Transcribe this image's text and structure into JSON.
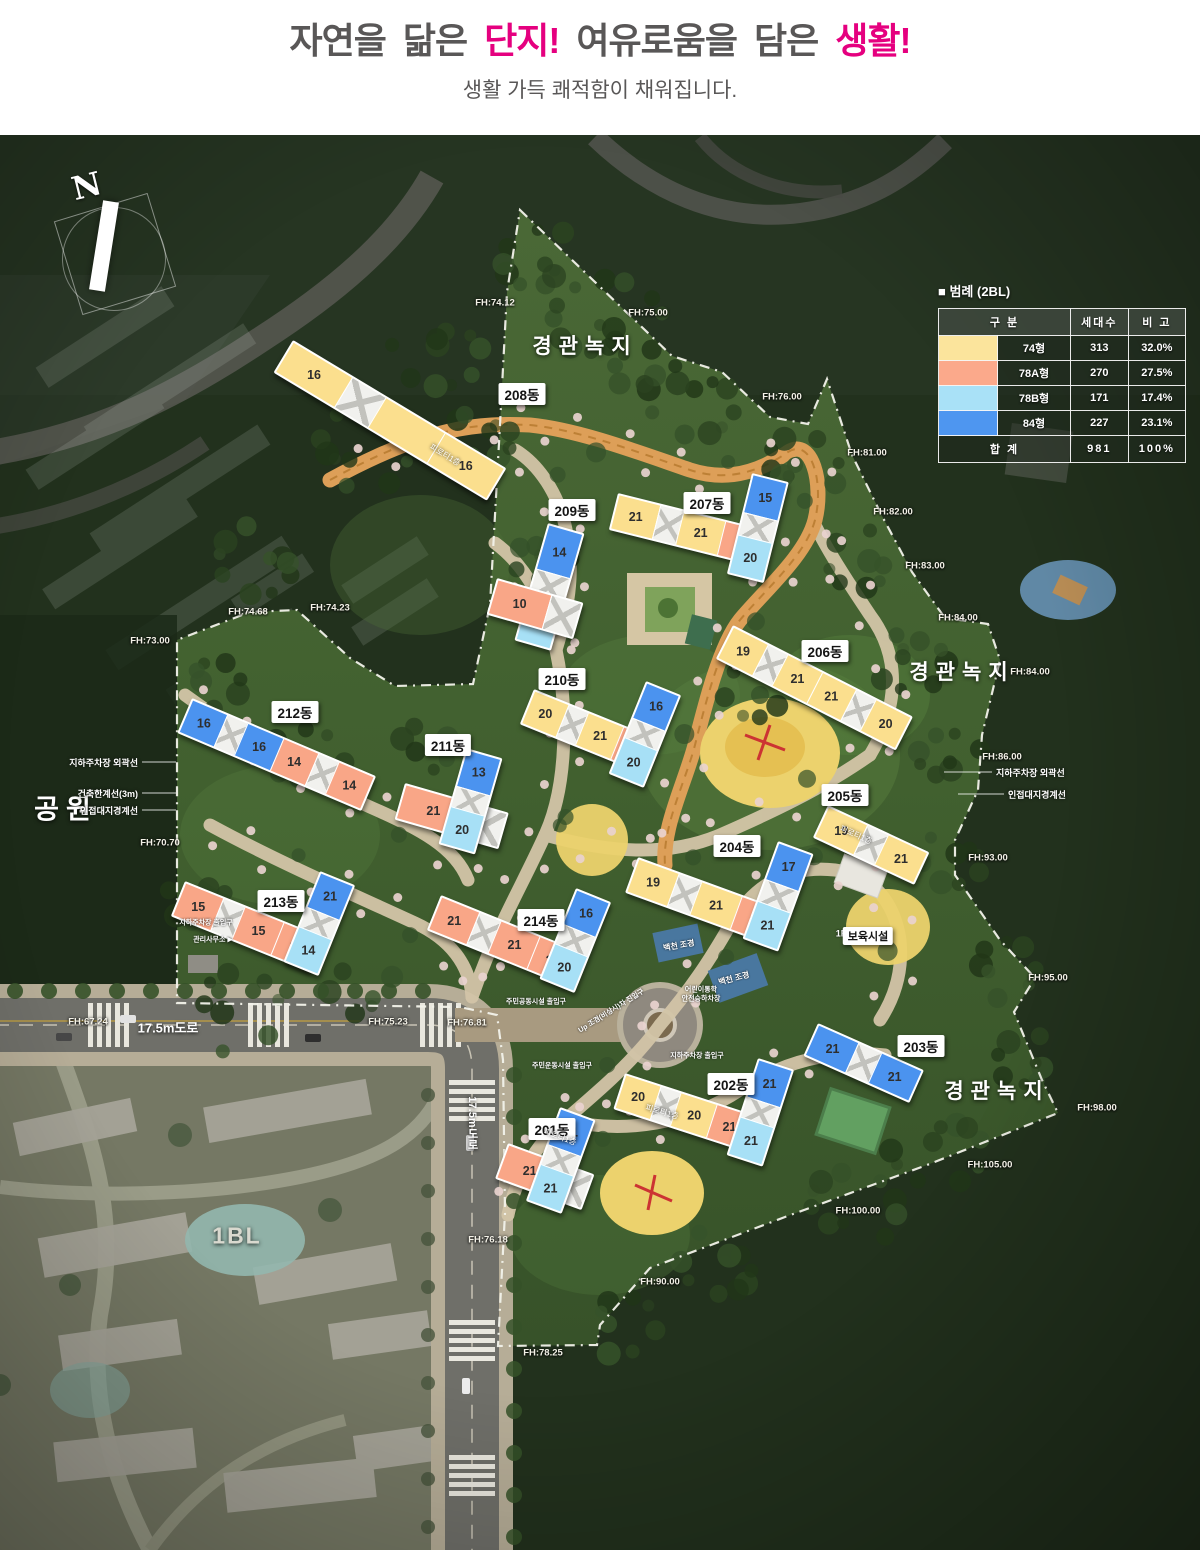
{
  "header": {
    "title_parts": [
      {
        "text": "자연을 닮은 ",
        "color": "#595757"
      },
      {
        "text": "단지!",
        "color": "#e5007f"
      },
      {
        "text": " 여유로움을 담은 ",
        "color": "#595757"
      },
      {
        "text": "생활!",
        "color": "#e5007f"
      }
    ],
    "subtitle": "생활 가득 쾌적함이 채워집니다."
  },
  "legend": {
    "title": "■  범례 (2BL)",
    "columns": [
      "구   분",
      "세대수",
      "비 고"
    ],
    "colors": {
      "Y": "#fbdf8e",
      "S": "#f9a687",
      "C": "#a7e0f6",
      "B": "#4b93ef",
      "W": "#ffffff"
    },
    "rows": [
      {
        "color": "#fbe49c",
        "type": "74형",
        "households": "313",
        "ratio": "32.0%"
      },
      {
        "color": "#fba98b",
        "type": "78A형",
        "households": "270",
        "ratio": "27.5%"
      },
      {
        "color": "#a9e1f7",
        "type": "78B형",
        "households": "171",
        "ratio": "17.4%"
      },
      {
        "color": "#4e96f0",
        "type": "84형",
        "households": "227",
        "ratio": "23.1%"
      }
    ],
    "total": {
      "label": "합 계",
      "households": "981",
      "ratio": "100%"
    }
  },
  "labels": {
    "north": "N",
    "green_zone": "경관녹지",
    "park": "공원",
    "block": "1BL",
    "road_17_5": "17.5m도로",
    "daycare": "보육시설",
    "daycare_floor": "1F",
    "stream": "백천 조경",
    "mgmt_office": "관리사무소 ▶",
    "parking_entrance": "지하주차장 출입구",
    "parking_entrance2": "지하주차장 출입구",
    "kids_dropoff": "어린이통학\n안전승하차장",
    "landscape_entry": "Up 조경(비상시)차 진입구",
    "community_entrance": "주민공동시설 출입구",
    "sports_entrance": "주민운동시설 출입구",
    "boundary_notes_left": [
      "지하주차장 외곽선",
      "건축한계선(3m)",
      "인접대지경계선"
    ],
    "boundary_notes_right": [
      "지하주차장 외곽선",
      "인접대지경계선"
    ]
  },
  "map": {
    "fh_points": [
      {
        "t": "FH:74.12",
        "x": 495,
        "y": 168
      },
      {
        "t": "FH:75.00",
        "x": 648,
        "y": 178
      },
      {
        "t": "FH:76.00",
        "x": 782,
        "y": 262
      },
      {
        "t": "FH:81.00",
        "x": 867,
        "y": 318
      },
      {
        "t": "FH:82.00",
        "x": 893,
        "y": 377
      },
      {
        "t": "FH:83.00",
        "x": 925,
        "y": 431
      },
      {
        "t": "FH:84.00",
        "x": 958,
        "y": 483
      },
      {
        "t": "FH:84.00",
        "x": 1030,
        "y": 537
      },
      {
        "t": "FH:86.00",
        "x": 1002,
        "y": 622
      },
      {
        "t": "FH:93.00",
        "x": 988,
        "y": 723
      },
      {
        "t": "FH:95.00",
        "x": 1048,
        "y": 843
      },
      {
        "t": "FH:98.00",
        "x": 1097,
        "y": 973
      },
      {
        "t": "FH:105.00",
        "x": 990,
        "y": 1030
      },
      {
        "t": "FH:100.00",
        "x": 858,
        "y": 1076
      },
      {
        "t": "FH:90.00",
        "x": 660,
        "y": 1147
      },
      {
        "t": "FH:78.25",
        "x": 543,
        "y": 1218
      },
      {
        "t": "FH:76.18",
        "x": 488,
        "y": 1105
      },
      {
        "t": "FH:67.24",
        "x": 88,
        "y": 887
      },
      {
        "t": "FH:75.23",
        "x": 388,
        "y": 887
      },
      {
        "t": "FH:76.81",
        "x": 467,
        "y": 888
      },
      {
        "t": "FH:74.68",
        "x": 248,
        "y": 477
      },
      {
        "t": "FH:74.23",
        "x": 330,
        "y": 473
      },
      {
        "t": "FH:73.00",
        "x": 150,
        "y": 506
      },
      {
        "t": "FH:70.70",
        "x": 160,
        "y": 708
      }
    ],
    "buildings": [
      {
        "name": "201동",
        "lx": 552,
        "ly": 994,
        "note": "피로티1층",
        "nx": 560,
        "ny": 1002,
        "nr": 20,
        "bars": [
          {
            "x": 508,
            "y": 1008,
            "w": 88,
            "h": 34,
            "rot": 20,
            "dir": "h",
            "segs": [
              {
                "c": "S",
                "n": "21"
              },
              {
                "c": "W"
              }
            ]
          },
          {
            "x": 560,
            "y": 972,
            "w": 34,
            "h": 96,
            "rot": 20,
            "dir": "v",
            "segs": [
              {
                "c": "B",
                "n": "21"
              },
              {
                "c": "W"
              },
              {
                "c": "C",
                "n": "21"
              }
            ]
          }
        ]
      },
      {
        "name": "202동",
        "lx": 731,
        "ly": 949,
        "note": "피로티1층",
        "nx": 662,
        "ny": 977,
        "nr": 16,
        "bars": [
          {
            "x": 625,
            "y": 938,
            "w": 132,
            "h": 34,
            "rot": 18,
            "dir": "h",
            "segs": [
              {
                "c": "Y",
                "n": "20"
              },
              {
                "c": "W"
              },
              {
                "c": "Y",
                "n": "20"
              },
              {
                "c": "S",
                "n": "21"
              }
            ]
          },
          {
            "x": 758,
            "y": 923,
            "w": 34,
            "h": 98,
            "rot": 18,
            "dir": "v",
            "segs": [
              {
                "c": "B",
                "n": "21"
              },
              {
                "c": "W"
              },
              {
                "c": "C",
                "n": "21"
              }
            ]
          }
        ]
      },
      {
        "name": "203동",
        "lx": 921,
        "ly": 911,
        "bars": [
          {
            "x": 818,
            "y": 888,
            "w": 112,
            "h": 32,
            "rot": 24,
            "dir": "h",
            "segs": [
              {
                "c": "B",
                "n": "21"
              },
              {
                "c": "W"
              },
              {
                "c": "B",
                "n": "21"
              }
            ]
          }
        ]
      },
      {
        "name": "204동",
        "lx": 737,
        "ly": 711,
        "bars": [
          {
            "x": 638,
            "y": 722,
            "w": 152,
            "h": 34,
            "rot": 20,
            "dir": "h",
            "segs": [
              {
                "c": "Y",
                "n": "19"
              },
              {
                "c": "W"
              },
              {
                "c": "Y",
                "n": "21"
              },
              {
                "c": "S",
                "n": "21"
              }
            ]
          },
          {
            "x": 778,
            "y": 706,
            "w": 34,
            "h": 100,
            "rot": 20,
            "dir": "v",
            "segs": [
              {
                "c": "B",
                "n": "17"
              },
              {
                "c": "W"
              },
              {
                "c": "C",
                "n": "21"
              }
            ]
          }
        ]
      },
      {
        "name": "205동",
        "lx": 845,
        "ly": 660,
        "note": "피로티1층",
        "nx": 856,
        "ny": 700,
        "nr": 24,
        "bars": [
          {
            "x": 828,
            "y": 670,
            "w": 108,
            "h": 32,
            "rot": 25,
            "dir": "h",
            "segs": [
              {
                "c": "Y",
                "n": "19"
              },
              {
                "c": "W"
              },
              {
                "c": "Y",
                "n": "21"
              }
            ]
          }
        ]
      },
      {
        "name": "206동",
        "lx": 825,
        "ly": 516,
        "bars": [
          {
            "x": 733,
            "y": 490,
            "w": 198,
            "h": 34,
            "rot": 27,
            "dir": "h",
            "segs": [
              {
                "c": "Y",
                "n": "19"
              },
              {
                "c": "W"
              },
              {
                "c": "Y",
                "n": "21"
              },
              {
                "c": "Y",
                "n": "21"
              },
              {
                "c": "W"
              },
              {
                "c": "Y",
                "n": "20"
              }
            ]
          }
        ]
      },
      {
        "name": "207동",
        "lx": 707,
        "ly": 368,
        "bars": [
          {
            "x": 618,
            "y": 358,
            "w": 152,
            "h": 34,
            "rot": 14,
            "dir": "h",
            "segs": [
              {
                "c": "Y",
                "n": "21"
              },
              {
                "c": "W"
              },
              {
                "c": "Y",
                "n": "21"
              },
              {
                "c": "S",
                "n": "21"
              }
            ]
          },
          {
            "x": 752,
            "y": 338,
            "w": 34,
            "h": 100,
            "rot": 14,
            "dir": "v",
            "segs": [
              {
                "c": "B",
                "n": "15"
              },
              {
                "c": "W"
              },
              {
                "c": "C",
                "n": "20"
              }
            ]
          }
        ]
      },
      {
        "name": "208동",
        "lx": 522,
        "ly": 259,
        "note": "피로티1층",
        "nx": 445,
        "ny": 320,
        "nr": 31,
        "bars": [
          {
            "x": 293,
            "y": 205,
            "w": 245,
            "h": 34,
            "rot": 31,
            "dir": "h",
            "segs": [
              {
                "c": "Y",
                "n": "16"
              },
              {
                "c": "W"
              },
              {
                "c": "Y"
              },
              {
                "c": "Y",
                "n": "16"
              }
            ]
          }
        ]
      },
      {
        "name": "209동",
        "lx": 572,
        "ly": 375,
        "bars": [
          {
            "x": 548,
            "y": 388,
            "w": 34,
            "h": 118,
            "rot": 16,
            "dir": "v",
            "segs": [
              {
                "c": "B",
                "n": "14"
              },
              {
                "c": "W"
              },
              {
                "c": "C",
                "n": "14"
              }
            ]
          },
          {
            "x": 497,
            "y": 443,
            "w": 86,
            "h": 34,
            "rot": 16,
            "dir": "h",
            "segs": [
              {
                "c": "S",
                "n": "10"
              },
              {
                "c": "W"
              }
            ]
          }
        ]
      },
      {
        "name": "210동",
        "lx": 562,
        "ly": 544,
        "bars": [
          {
            "x": 534,
            "y": 554,
            "w": 132,
            "h": 34,
            "rot": 22,
            "dir": "h",
            "segs": [
              {
                "c": "Y",
                "n": "20"
              },
              {
                "c": "W"
              },
              {
                "c": "Y",
                "n": "21"
              },
              {
                "c": "S",
                "n": "20"
              }
            ]
          },
          {
            "x": 646,
            "y": 546,
            "w": 34,
            "h": 96,
            "rot": 22,
            "dir": "v",
            "segs": [
              {
                "c": "B",
                "n": "16"
              },
              {
                "c": "W"
              },
              {
                "c": "C",
                "n": "20"
              }
            ]
          }
        ]
      },
      {
        "name": "211동",
        "lx": 448,
        "ly": 610,
        "bars": [
          {
            "x": 405,
            "y": 648,
            "w": 104,
            "h": 34,
            "rot": 16,
            "dir": "h",
            "segs": [
              {
                "c": "S",
                "n": "21"
              },
              {
                "c": "W"
              }
            ]
          },
          {
            "x": 466,
            "y": 613,
            "w": 34,
            "h": 96,
            "rot": 16,
            "dir": "v",
            "segs": [
              {
                "c": "B",
                "n": "13"
              },
              {
                "c": "W"
              },
              {
                "c": "C",
                "n": "20"
              }
            ]
          }
        ]
      },
      {
        "name": "212동",
        "lx": 295,
        "ly": 577,
        "bars": [
          {
            "x": 192,
            "y": 563,
            "w": 196,
            "h": 34,
            "rot": 23,
            "dir": "h",
            "segs": [
              {
                "c": "B",
                "n": "16"
              },
              {
                "c": "W"
              },
              {
                "c": "B",
                "n": "16"
              },
              {
                "c": "S",
                "n": "14"
              },
              {
                "c": "W"
              },
              {
                "c": "S",
                "n": "14"
              }
            ]
          }
        ]
      },
      {
        "name": "213동",
        "lx": 281,
        "ly": 766,
        "bars": [
          {
            "x": 185,
            "y": 746,
            "w": 146,
            "h": 34,
            "rot": 22,
            "dir": "h",
            "segs": [
              {
                "c": "S",
                "n": "15"
              },
              {
                "c": "W"
              },
              {
                "c": "S",
                "n": "15"
              },
              {
                "c": "S",
                "n": "15"
              }
            ]
          },
          {
            "x": 320,
            "y": 736,
            "w": 34,
            "h": 94,
            "rot": 22,
            "dir": "v",
            "segs": [
              {
                "c": "B",
                "n": "21"
              },
              {
                "c": "W"
              },
              {
                "c": "C",
                "n": "14"
              }
            ]
          }
        ]
      },
      {
        "name": "214동",
        "lx": 541,
        "ly": 785,
        "bars": [
          {
            "x": 441,
            "y": 760,
            "w": 146,
            "h": 34,
            "rot": 22,
            "dir": "h",
            "segs": [
              {
                "c": "S",
                "n": "21"
              },
              {
                "c": "W"
              },
              {
                "c": "S",
                "n": "21"
              },
              {
                "c": "S",
                "n": "20"
              }
            ]
          },
          {
            "x": 576,
            "y": 753,
            "w": 34,
            "h": 94,
            "rot": 22,
            "dir": "v",
            "segs": [
              {
                "c": "B",
                "n": "16"
              },
              {
                "c": "W"
              },
              {
                "c": "C",
                "n": "20"
              }
            ]
          }
        ]
      }
    ]
  }
}
